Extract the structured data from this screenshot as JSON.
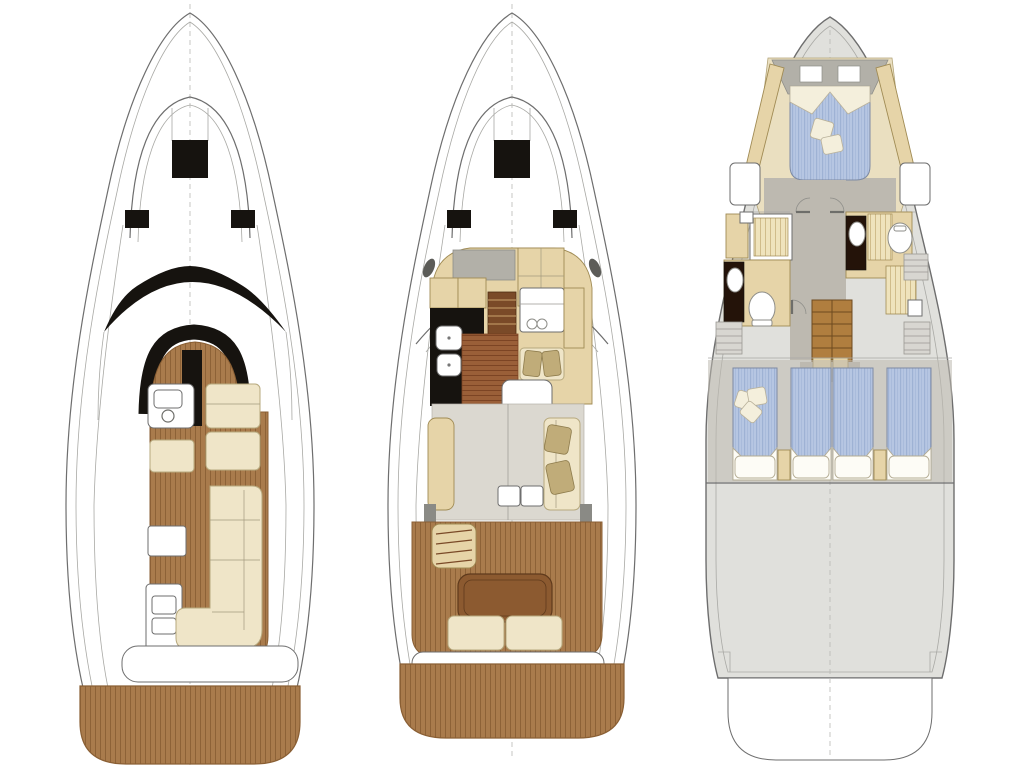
{
  "figure": {
    "type": "yacht-deck-plan",
    "views": 3
  },
  "decks": [
    {
      "id": "flybridge",
      "label": "Flybridge deck plan"
    },
    {
      "id": "main-deck",
      "label": "Main deck plan"
    },
    {
      "id": "lower-deck",
      "label": "Lower deck plan"
    }
  ],
  "features": {
    "flybridge": [
      "foredeck-sun-hatch",
      "windscreen-band",
      "helm-console",
      "helm-seats",
      "wet-bar",
      "l-shaped-settee",
      "teak-deck",
      "swim-platform"
    ],
    "main_deck": [
      "foredeck-sun-hatch",
      "galley-counter",
      "fridge-drawers",
      "companionway-steps",
      "helm-station",
      "dinette",
      "salon-sofa",
      "cockpit-table",
      "cockpit-bench",
      "swim-platform"
    ],
    "lower_deck": [
      "vip-double-bed",
      "port-head",
      "starboard-head",
      "shower-stalls",
      "staircase",
      "twin-cabin-port",
      "twin-cabin-starboard",
      "engine-room"
    ]
  },
  "palette": {
    "hull_outline": "#6e6e6e",
    "hull_outline_light": "#a9a9a5",
    "teak": "#a97b4c",
    "teak_stripe": "#8a5f34",
    "cream": "#efe5c8",
    "cream_stroke": "#b7a97e",
    "tan": "#e6d4a8",
    "tan_stroke": "#a08b54",
    "black": "#16130f",
    "wood_floor": "#9a5f38",
    "wood_floor_stripe": "#7c4424",
    "wood_table": "#8c5a30",
    "stair_wood": "#b07e3f",
    "gray_hull": "#e0e0dc",
    "gray_floor": "#bdb9b0",
    "gray_panel": "#b2b0a8",
    "salon_floor": "#dbd8d0",
    "blue_bed": "#b6c6e2",
    "blue_stripe": "#9db1d4",
    "shower_floor": "#efe3bc",
    "shower_stripe": "#c9b27e",
    "pillow_white": "#f4efdc",
    "pillow_khaki": "#c0ac79",
    "dark_vanity": "#241309"
  }
}
